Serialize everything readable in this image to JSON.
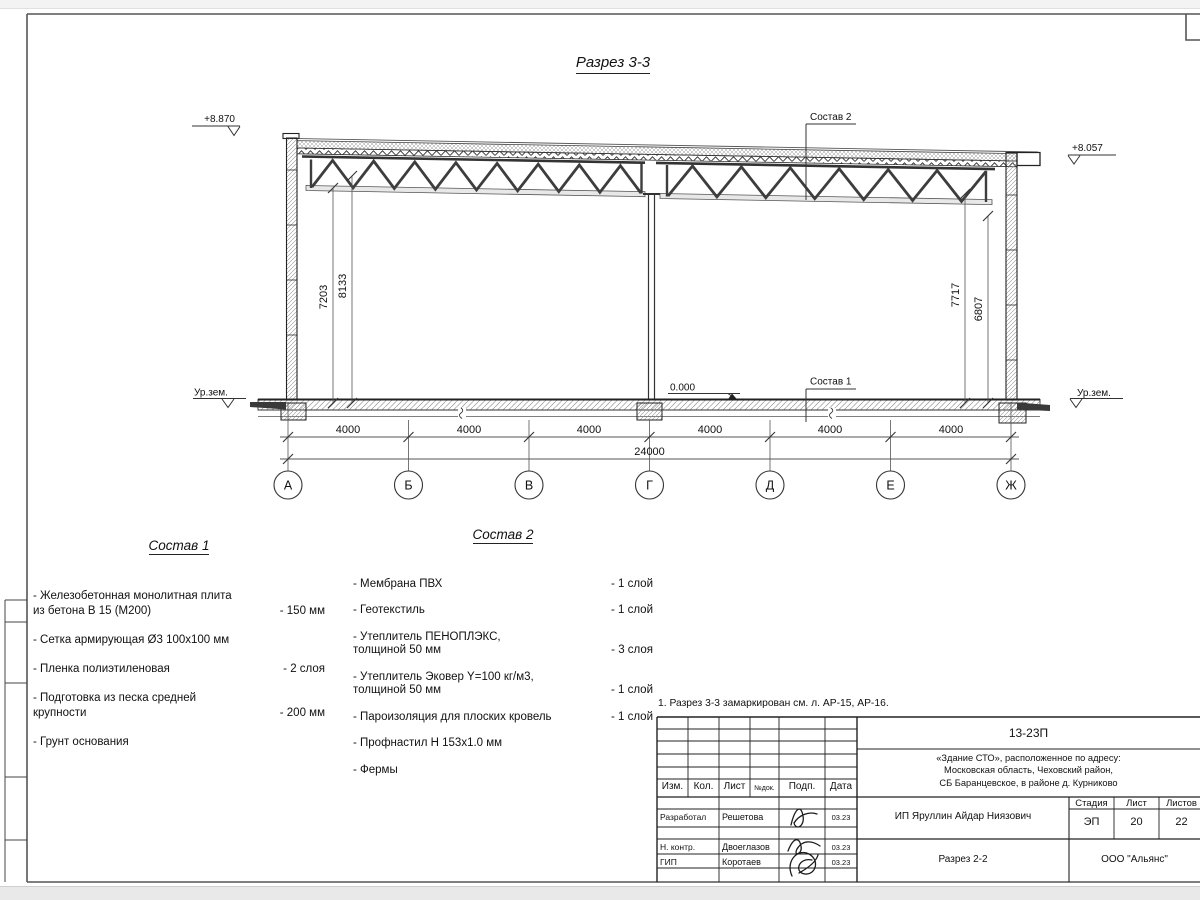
{
  "drawing": {
    "title": "Разрез 3-3",
    "elevation_left": "+8.870",
    "elevation_right": "+8.057",
    "zero_level": "0.000",
    "ground_left": "Ур.зем.",
    "ground_right": "Ур.зем.",
    "leader_roof": "Состав 2",
    "leader_floor": "Состав 1",
    "axes": [
      "А",
      "Б",
      "В",
      "Г",
      "Д",
      "Е",
      "Ж"
    ],
    "span_dims": [
      "4000",
      "4000",
      "4000",
      "4000",
      "4000",
      "4000"
    ],
    "total_dim": "24000",
    "vdims": [
      "7203",
      "8133",
      "7717",
      "6807"
    ]
  },
  "sostav1": {
    "heading": "Состав 1",
    "items": [
      {
        "line1": "- Железобетонная  монолитная плита",
        "line2": "из бетона В 15 (М200)",
        "value": "- 150 мм"
      },
      {
        "line1": "- Сетка армирующая Ø3 100х100 мм",
        "line2": "",
        "value": ""
      },
      {
        "line1": "- Пленка полиэтиленовая",
        "line2": "",
        "value": "-  2 слоя"
      },
      {
        "line1": "- Подготовка из песка средней",
        "line2": "крупности",
        "value": "- 200 мм"
      },
      {
        "line1": "- Грунт основания",
        "line2": "",
        "value": ""
      }
    ]
  },
  "sostav2": {
    "heading": "Состав 2",
    "items": [
      {
        "line1": "- Мембрана ПВХ",
        "line2": "",
        "value": "- 1 слой"
      },
      {
        "line1": "- Геотекстиль",
        "line2": "",
        "value": "- 1 слой"
      },
      {
        "line1": "- Утеплитель ПЕНОПЛЭКС,",
        "line2": "толщиной 50 мм",
        "value": "- 3 слоя"
      },
      {
        "line1": "- Утеплитель Эковер Y=100 кг/м3,",
        "line2": "толщиной 50 мм",
        "value": "- 1 слой"
      },
      {
        "line1": "- Пароизоляция для плоских кровель",
        "line2": "",
        "value": "- 1 слой"
      },
      {
        "line1": "- Профнастил Н 153х1.0 мм",
        "line2": "",
        "value": ""
      },
      {
        "line1": "- Фермы",
        "line2": "",
        "value": ""
      }
    ]
  },
  "note": "1. Разрез 3-3 замаркирован см. л. АР-15, АР-16.",
  "titleblock": {
    "code": "13-23П",
    "object_line1": "«Здание СТО», расположенное по адресу:",
    "object_line2": "Московская область, Чеховский район,",
    "object_line3": "СБ Баранцевское, в районе д. Курниково",
    "client": "ИП Яруллин Айдар Ниязович",
    "sheet_title": "Разрез 2-2",
    "company": "ООО \"Альянс\"",
    "cols": [
      "Изм.",
      "Кол.",
      "Лист",
      "№док.",
      "Подп.",
      "Дата"
    ],
    "stage_label": "Стадия",
    "sheet_label": "Лист",
    "sheets_label": "Листов",
    "stage": "ЭП",
    "sheet_no": "20",
    "sheets_total": "22",
    "rows": [
      {
        "role": "Разработал",
        "name": "Решетова",
        "date": "03.23"
      },
      {
        "role": "Н. контр.",
        "name": "Двоеглазов",
        "date": "03.23"
      },
      {
        "role": "ГИП",
        "name": "Коротаев",
        "date": "03.23"
      }
    ]
  }
}
